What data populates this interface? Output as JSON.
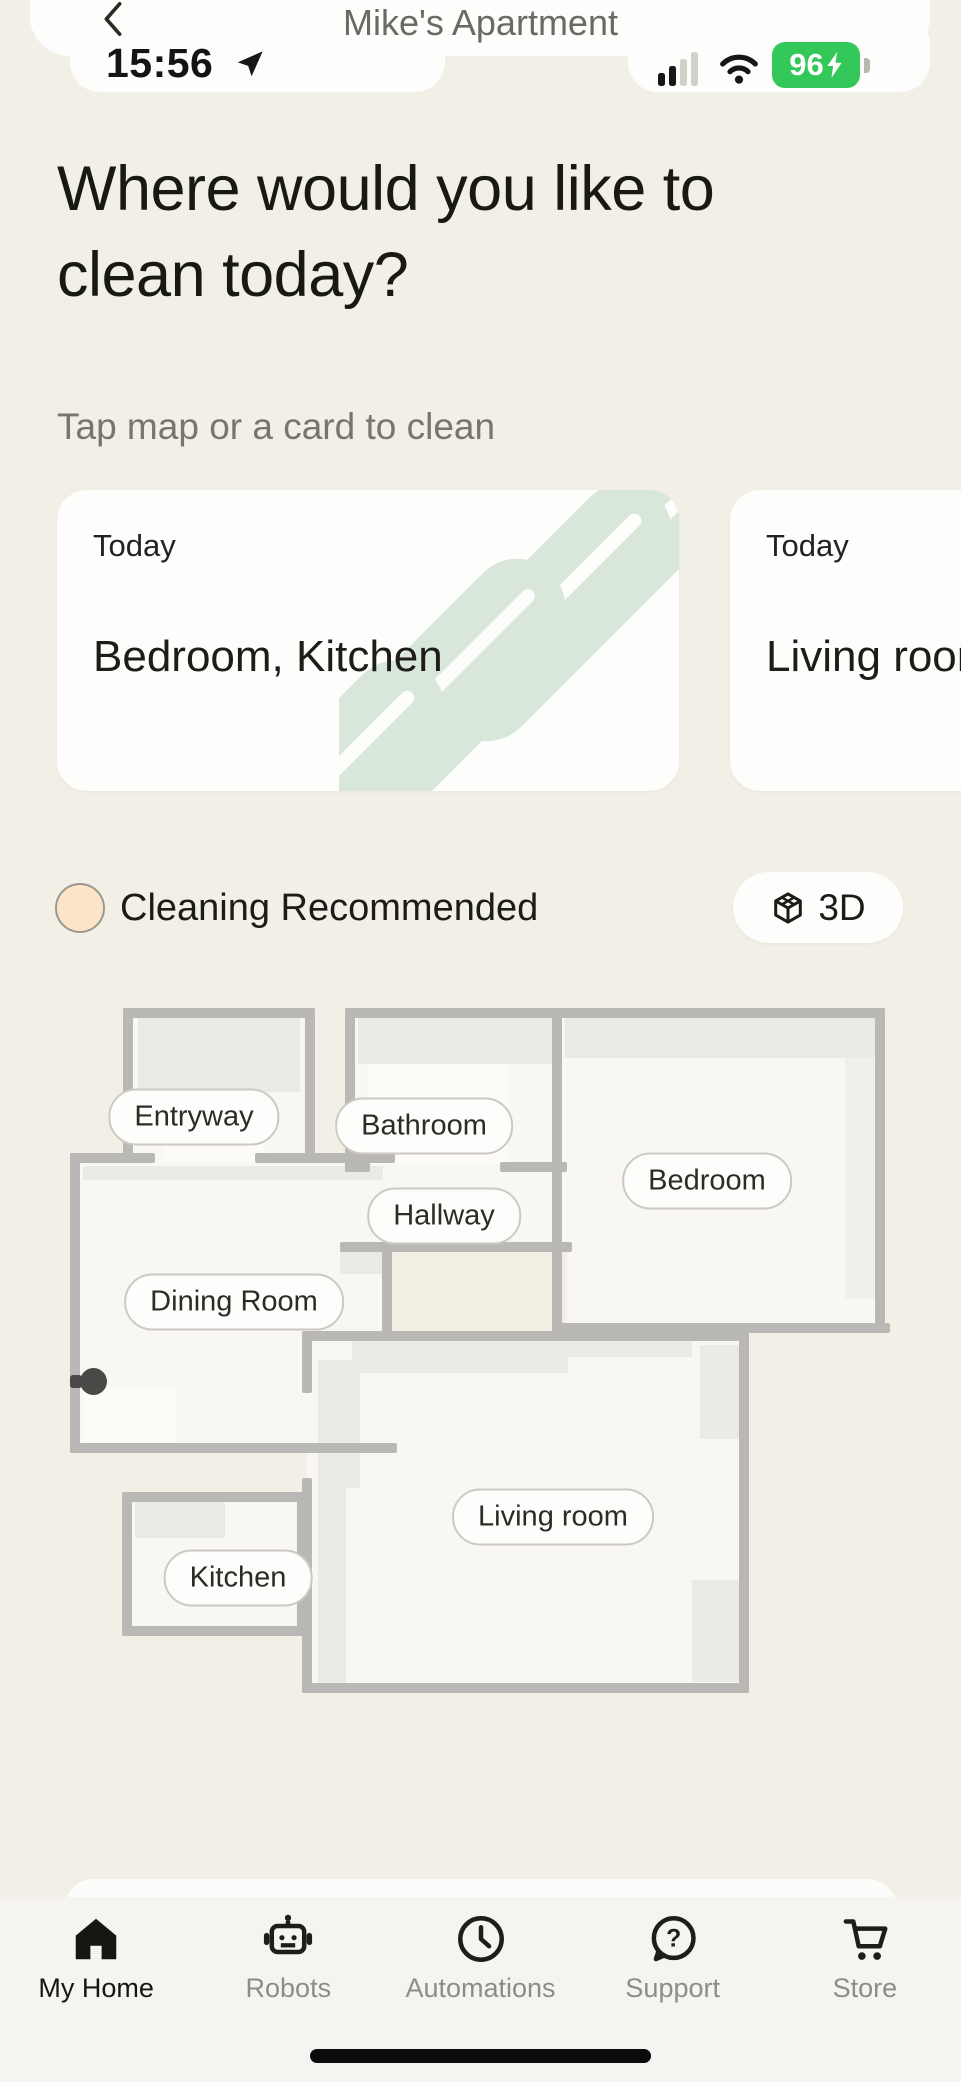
{
  "status_bar": {
    "time": "15:56",
    "battery_percent": "96",
    "icons": [
      "location-arrow-icon",
      "cellular-signal-icon",
      "wifi-icon",
      "battery-charging-icon"
    ],
    "battery_color": "#34c759"
  },
  "header": {
    "title": "Mike's Apartment",
    "back_icon": "chevron-left-icon"
  },
  "hero": {
    "title_line1": "Where would you like to",
    "title_line2": "clean today?",
    "subtitle": "Tap map or a card to clean"
  },
  "cards": [
    {
      "eyebrow": "Today",
      "title": "Bedroom, Kitchen"
    },
    {
      "eyebrow": "Today",
      "title": "Living room"
    }
  ],
  "legend": {
    "label": "Cleaning Recommended",
    "swatch_color": "#fce4c8",
    "view_button": {
      "icon": "cube-3d-icon",
      "label": "3D"
    }
  },
  "map": {
    "rooms": [
      {
        "label": "Entryway"
      },
      {
        "label": "Bathroom"
      },
      {
        "label": "Bedroom"
      },
      {
        "label": "Hallway"
      },
      {
        "label": "Dining Room"
      },
      {
        "label": "Kitchen"
      },
      {
        "label": "Living room"
      }
    ],
    "robot_marker": "robot-position-dot",
    "wall_color": "#b9b8b5"
  },
  "tab_bar": {
    "items": [
      {
        "label": "My Home",
        "icon": "home-icon",
        "active": true
      },
      {
        "label": "Robots",
        "icon": "robot-icon",
        "active": false
      },
      {
        "label": "Automations",
        "icon": "clock-icon",
        "active": false
      },
      {
        "label": "Support",
        "icon": "help-chat-icon",
        "active": false
      },
      {
        "label": "Store",
        "icon": "cart-icon",
        "active": false
      }
    ]
  },
  "colors": {
    "background": "#f2efe7",
    "card": "#fdfdfc",
    "accent_mint": "#d9e7da",
    "accent_peach": "#fce4c8",
    "battery_green": "#34c759",
    "wall_gray": "#b9b8b5"
  }
}
